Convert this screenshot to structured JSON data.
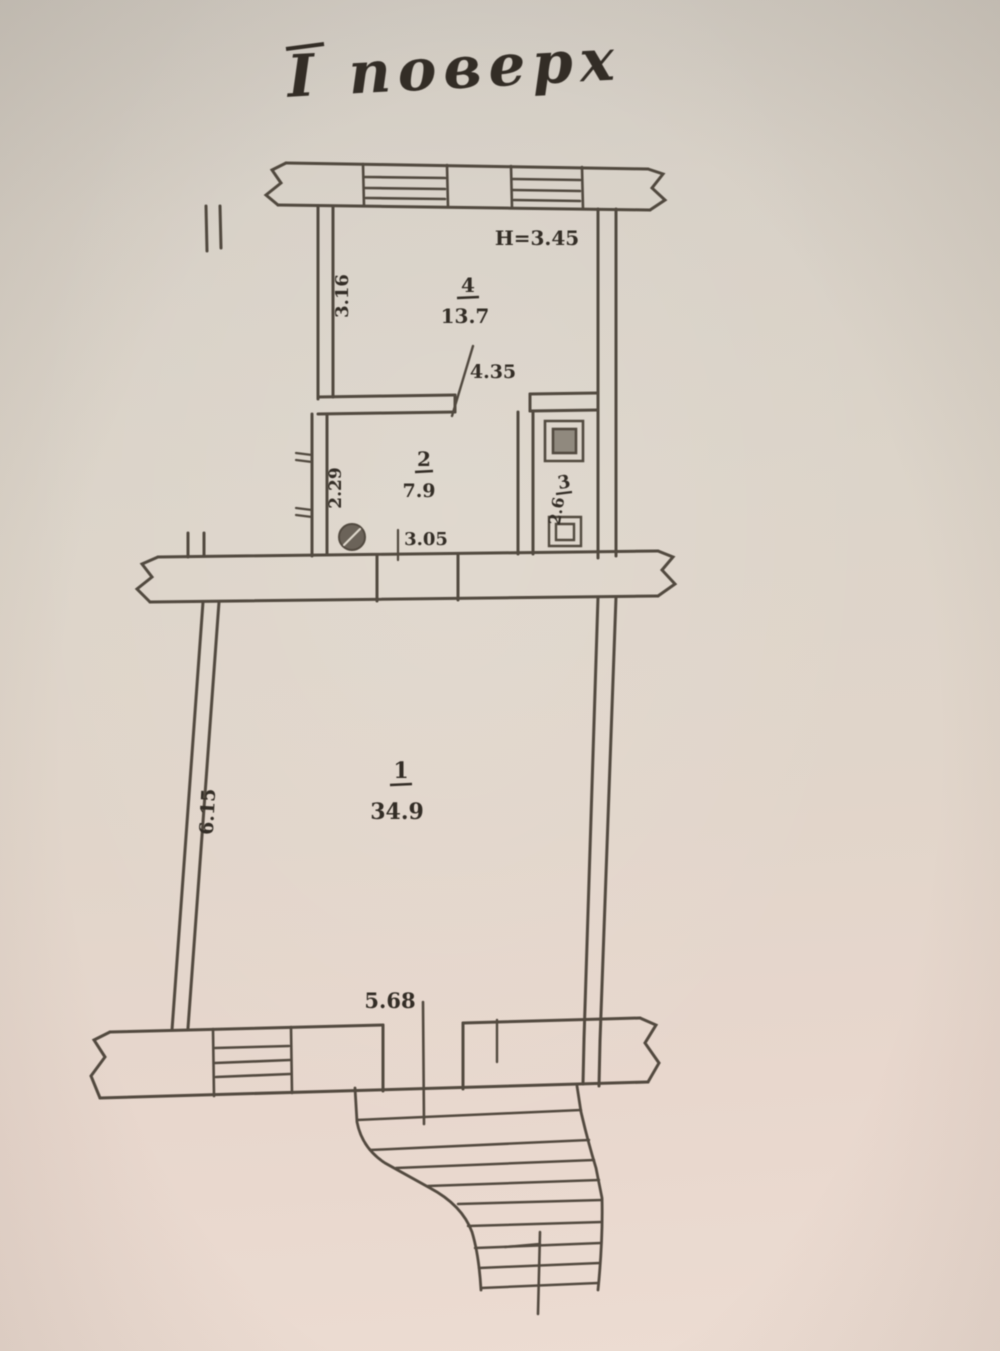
{
  "document": {
    "title": "І поверх",
    "kind": "floor-plan-scan"
  },
  "plan": {
    "ceiling_height_label": "H=3.45",
    "rooms": [
      {
        "number": "1",
        "area": "34.9",
        "width_label": "5.68",
        "depth_label": "6.15"
      },
      {
        "number": "2",
        "area": "7.9",
        "width_label": "3.05",
        "depth_label": "2.29"
      },
      {
        "number": "3",
        "area": "2.6"
      },
      {
        "number": "4",
        "area": "13.7",
        "width_label": "4.35",
        "depth_label": "3.16"
      }
    ],
    "features": [
      "two top windows",
      "one bottom window",
      "stove",
      "sink",
      "toilet",
      "winder staircase"
    ]
  },
  "colors": {
    "paper_top": "#cfc9c0",
    "paper_bottom": "#ecdcd2",
    "ink": "#3e362c",
    "text_ink": "#332d26"
  }
}
